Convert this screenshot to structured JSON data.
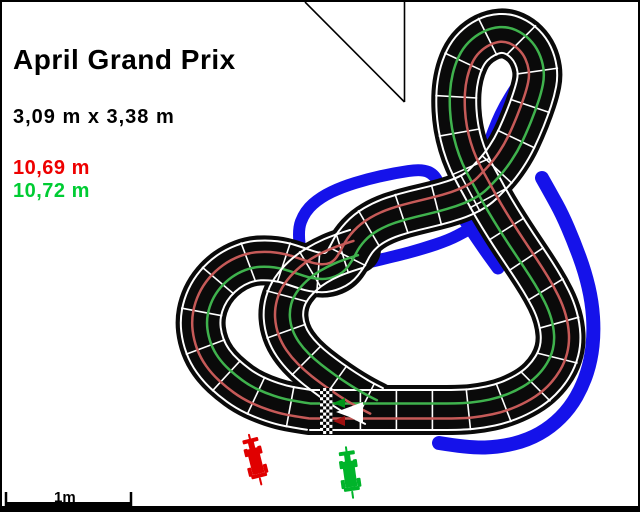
{
  "header": {
    "title": "April Grand Prix",
    "dimensions": "3,09 m x 3,38 m",
    "lane_red_length": "10,69 m",
    "lane_green_length": "10,72 m"
  },
  "scalebar": {
    "label": "1m"
  },
  "colors": {
    "red_text": "#ee0000",
    "green_text": "#00cc33",
    "track_black": "#0a0a0a",
    "track_red_line": "#c65a58",
    "track_green_line": "#3fb24d",
    "lane_edge_white": "#ffffff",
    "border_blue": "#1512ea",
    "arrow_white": "#ffffff",
    "arrow_green": "#009418",
    "arrow_red": "#a01010"
  },
  "plan": {
    "half_width": 25,
    "edge_offset": 20,
    "green_offset": 6.5,
    "red_offset": -8.5,
    "joint_spacing": 36,
    "joint_half": 21,
    "lap": [
      [
        308,
        408
      ],
      [
        340,
        408
      ],
      [
        380,
        408
      ],
      [
        420,
        408
      ],
      [
        460,
        408
      ],
      [
        479,
        406
      ],
      [
        498,
        402
      ],
      [
        516,
        395
      ],
      [
        533,
        385
      ],
      [
        546,
        372
      ],
      [
        555,
        357
      ],
      [
        559,
        341
      ],
      [
        558,
        324
      ],
      [
        553,
        306
      ],
      [
        544,
        288
      ],
      [
        533,
        270
      ],
      [
        521,
        252
      ],
      [
        509,
        234
      ],
      [
        497,
        215
      ],
      [
        487,
        198
      ],
      [
        479,
        183
      ],
      [
        470,
        167
      ],
      [
        463,
        151
      ],
      [
        458,
        134
      ],
      [
        455,
        117
      ],
      [
        454,
        99
      ],
      [
        455,
        82
      ],
      [
        459,
        65
      ],
      [
        466,
        50
      ],
      [
        477,
        39
      ],
      [
        491,
        32
      ],
      [
        505,
        31
      ],
      [
        518,
        37
      ],
      [
        528,
        47
      ],
      [
        534,
        60
      ],
      [
        536,
        74
      ],
      [
        533,
        89
      ],
      [
        527,
        107
      ],
      [
        519,
        127
      ],
      [
        510,
        146
      ],
      [
        498,
        164
      ],
      [
        486,
        177
      ],
      [
        476,
        187
      ],
      [
        461,
        195
      ],
      [
        443,
        201
      ],
      [
        423,
        206
      ],
      [
        402,
        211
      ],
      [
        381,
        218
      ],
      [
        364,
        228
      ],
      [
        352,
        241
      ],
      [
        345,
        255
      ],
      [
        337,
        266
      ],
      [
        325,
        271
      ],
      [
        311,
        270
      ],
      [
        296,
        265
      ],
      [
        281,
        260
      ],
      [
        265,
        258
      ],
      [
        249,
        259
      ],
      [
        233,
        265
      ],
      [
        219,
        275
      ],
      [
        208,
        288
      ],
      [
        201,
        303
      ],
      [
        198,
        319
      ],
      [
        200,
        336
      ],
      [
        206,
        352
      ],
      [
        216,
        366
      ],
      [
        229,
        378
      ],
      [
        244,
        389
      ],
      [
        261,
        397
      ],
      [
        279,
        403
      ],
      [
        295,
        406
      ],
      [
        308,
        408
      ]
    ],
    "hook": [
      [
        354,
        247
      ],
      [
        338,
        252
      ],
      [
        322,
        259
      ],
      [
        307,
        268
      ],
      [
        294,
        280
      ],
      [
        285,
        293
      ],
      [
        281,
        308
      ],
      [
        282,
        323
      ],
      [
        287,
        337
      ],
      [
        296,
        350
      ],
      [
        308,
        362
      ],
      [
        322,
        373
      ],
      [
        336,
        383
      ],
      [
        350,
        392
      ],
      [
        362,
        399
      ],
      [
        372,
        404
      ]
    ],
    "blue_borders": [
      {
        "w": 14,
        "points": [
          [
            437,
            441
          ],
          [
            468,
            446
          ],
          [
            498,
            445
          ],
          [
            526,
            438
          ],
          [
            549,
            425
          ],
          [
            568,
            406
          ],
          [
            581,
            383
          ],
          [
            589,
            358
          ],
          [
            592,
            330
          ],
          [
            590,
            300
          ],
          [
            583,
            270
          ],
          [
            572,
            240
          ],
          [
            560,
            212
          ],
          [
            549,
            192
          ],
          [
            540,
            176
          ]
        ]
      },
      {
        "w": 13,
        "points": [
          [
            455,
            206
          ],
          [
            468,
            226
          ],
          [
            483,
            248
          ],
          [
            496,
            266
          ]
        ]
      },
      {
        "w": 12,
        "points": [
          [
            479,
            167
          ],
          [
            486,
            144
          ],
          [
            494,
            122
          ],
          [
            503,
            103
          ],
          [
            513,
            87
          ]
        ]
      },
      {
        "w": 12,
        "points": [
          [
            299,
            251
          ],
          [
            295,
            230
          ],
          [
            303,
            209
          ],
          [
            319,
            195
          ],
          [
            340,
            185
          ],
          [
            366,
            177
          ],
          [
            393,
            171
          ],
          [
            420,
            167
          ],
          [
            433,
            173
          ],
          [
            439,
            188
          ]
        ]
      },
      {
        "w": 12,
        "points": [
          [
            368,
            260
          ],
          [
            394,
            254
          ],
          [
            420,
            247
          ],
          [
            447,
            238
          ],
          [
            464,
            229
          ]
        ]
      }
    ],
    "checkered": {
      "x": 318,
      "y": 386,
      "cols": 4,
      "rows": 15,
      "cell_w": 3.1,
      "cell_h": 3.07
    },
    "arrows": {
      "big_white": [
        [
          334,
          410
        ],
        [
          361,
          400
        ],
        [
          361,
          420
        ]
      ],
      "small_green": [
        [
          331,
          401
        ],
        [
          343,
          396
        ],
        [
          343,
          406
        ]
      ],
      "small_red": [
        [
          331,
          419
        ],
        [
          343,
          414
        ],
        [
          343,
          424
        ]
      ]
    },
    "fold": {
      "vline": [
        402.5,
        0,
        402.5,
        100
      ],
      "diag": [
        303,
        0,
        402.5,
        100
      ]
    },
    "scalebar_geom": {
      "x1": 3,
      "x2": 130,
      "y": 502,
      "tick_top": 490,
      "label_x": 52,
      "label_y": 500
    },
    "cars": [
      {
        "color": "#e00000",
        "x": 254,
        "y": 461,
        "rot": -14
      },
      {
        "color": "#00b42a",
        "x": 348,
        "y": 474,
        "rot": -8
      }
    ],
    "car_shape": [
      [
        -1,
        -30,
        2,
        7
      ],
      [
        -8,
        -25,
        16,
        4
      ],
      [
        -3,
        -22,
        6,
        9
      ],
      [
        -9,
        -16,
        4,
        8
      ],
      [
        5,
        -16,
        4,
        8
      ],
      [
        -6,
        -15,
        12,
        26
      ],
      [
        -10,
        3,
        4,
        9
      ],
      [
        6,
        3,
        4,
        9
      ],
      [
        -8,
        11,
        16,
        4
      ],
      [
        -1,
        15,
        2,
        8
      ]
    ]
  }
}
